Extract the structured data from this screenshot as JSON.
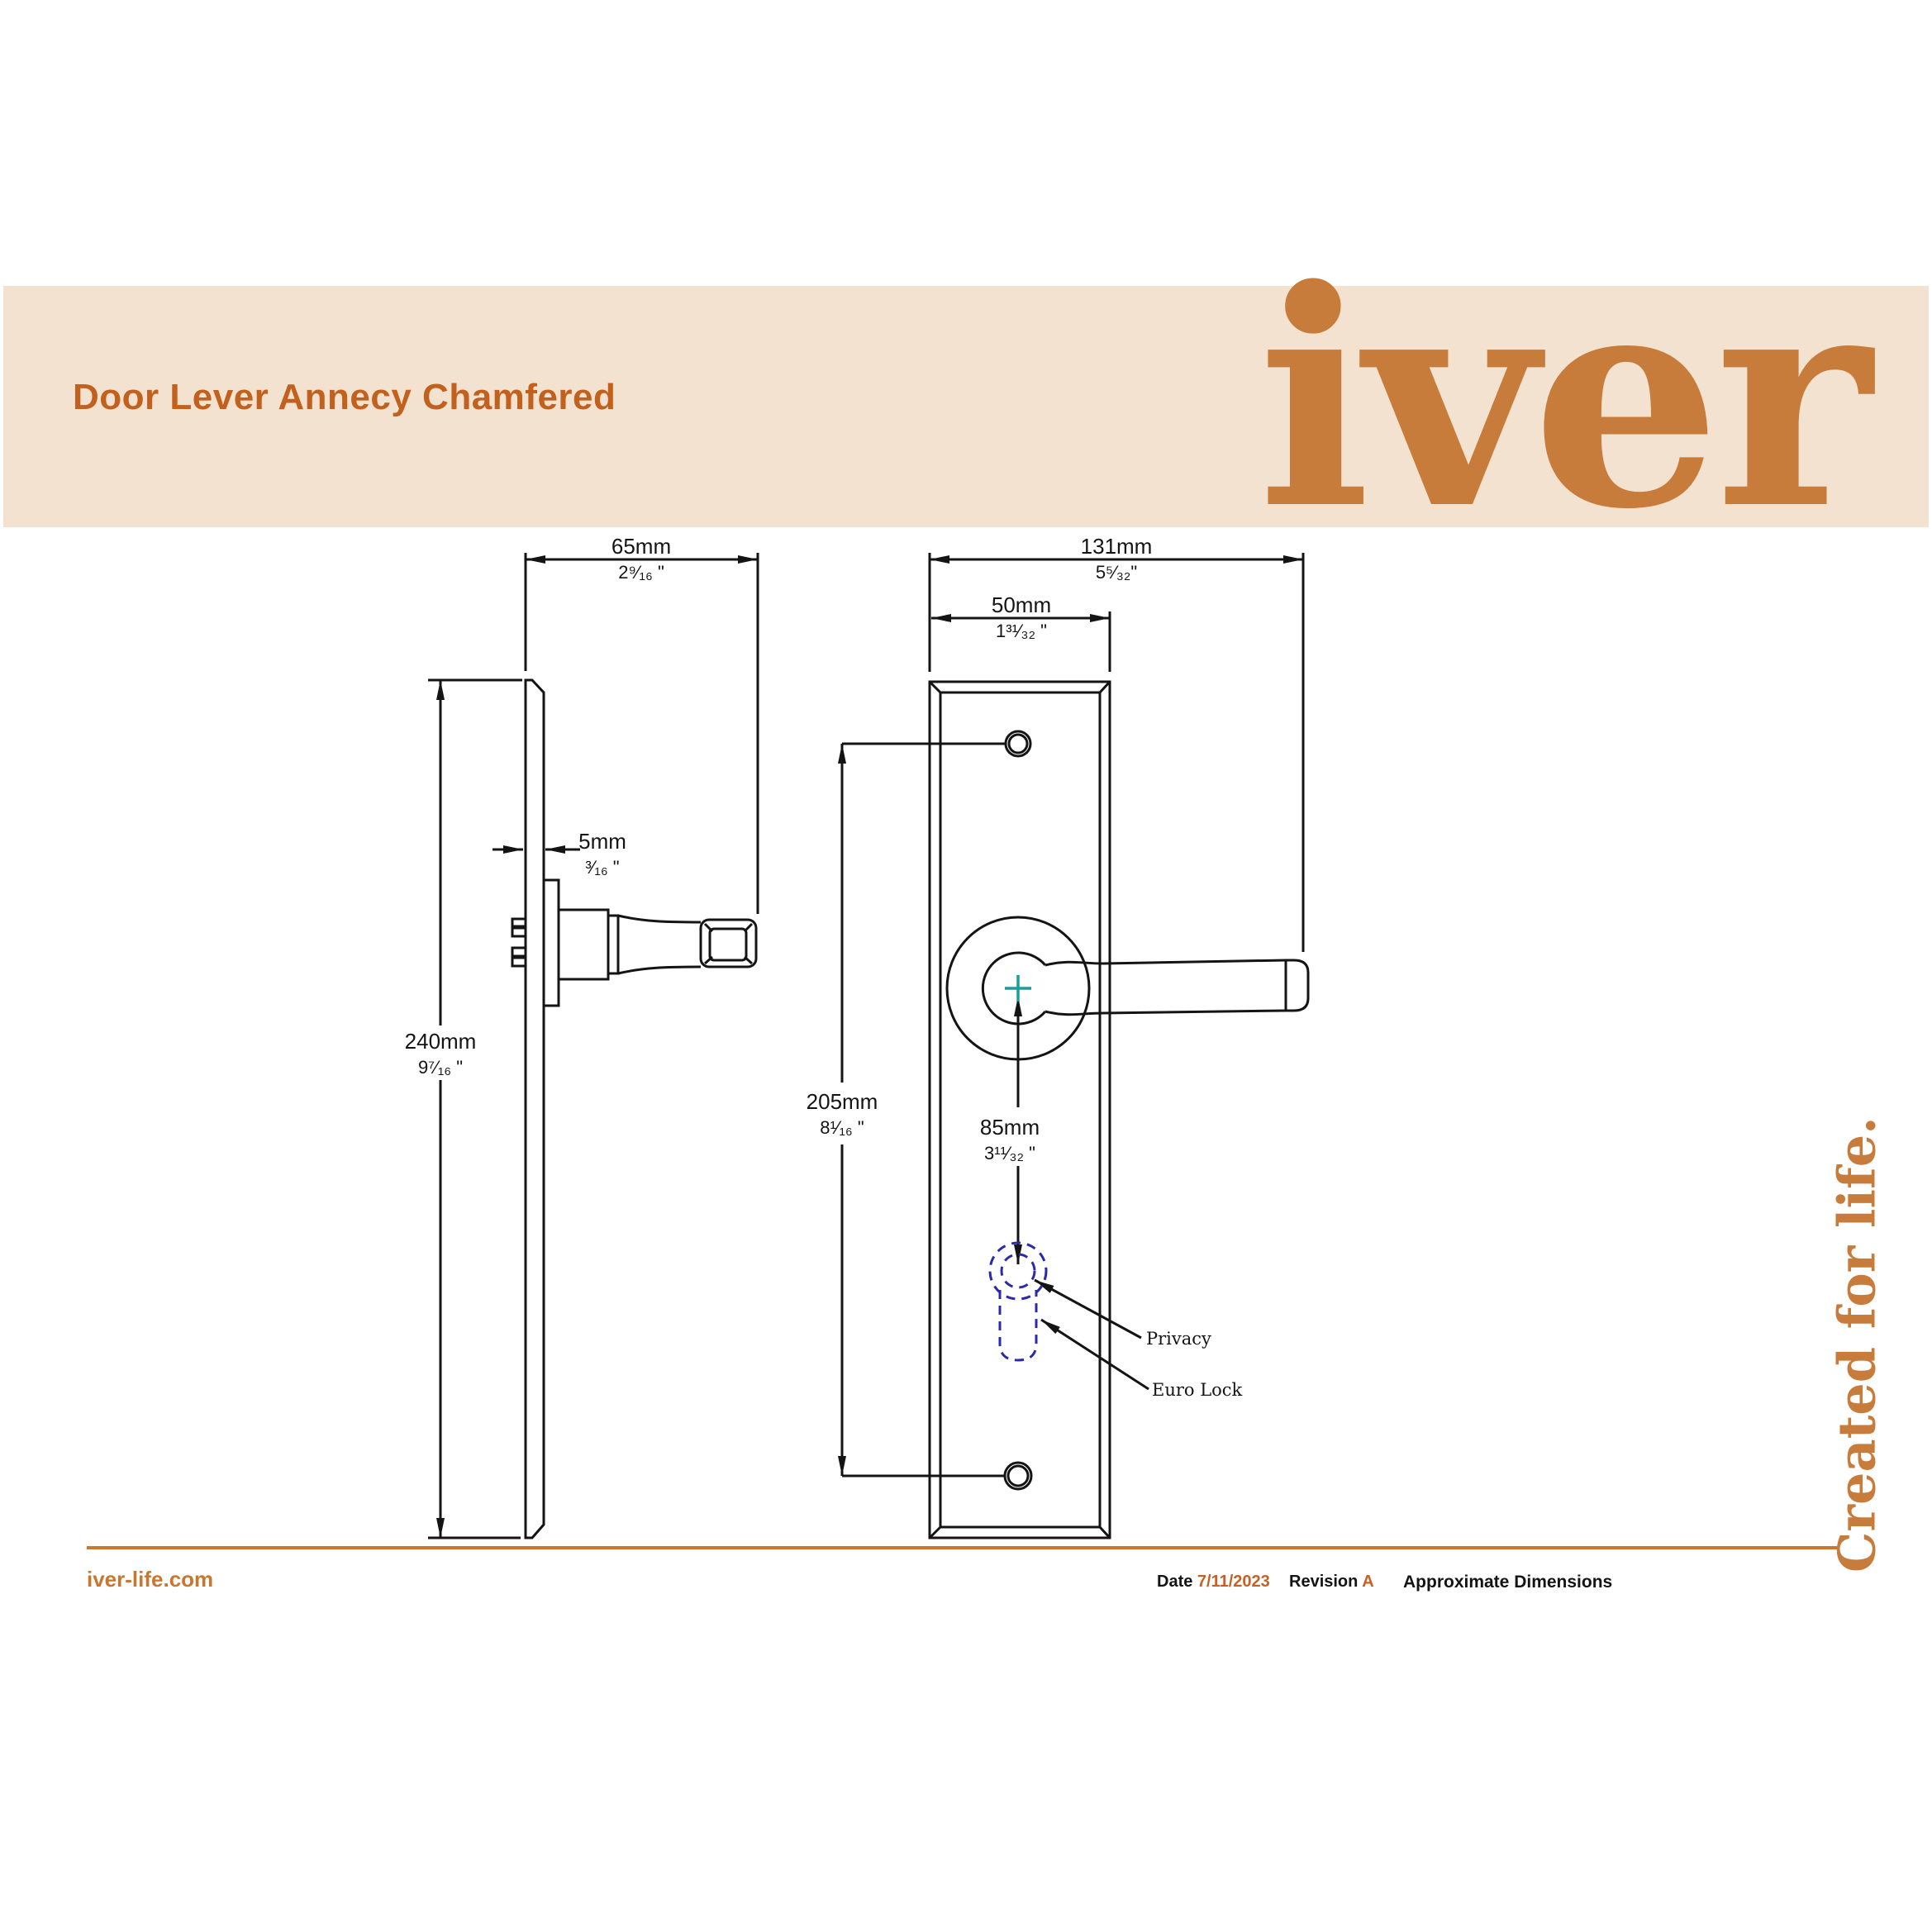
{
  "header": {
    "title": "Door Lever Annecy Chamfered",
    "logo_text": "iver"
  },
  "tagline": "Created for life.",
  "dims": {
    "plate_depth": {
      "mm": "65mm",
      "inch": "2⁹⁄₁₆ \""
    },
    "plate_thickness": {
      "mm": "5mm",
      "inch": "³⁄₁₆ \""
    },
    "plate_height": {
      "mm": "240mm",
      "inch": "9⁷⁄₁₆ \""
    },
    "overall_width": {
      "mm": "131mm",
      "inch": "5⁵⁄₃₂\""
    },
    "plate_width": {
      "mm": "50mm",
      "inch": "1³¹⁄₃₂ \""
    },
    "screw_centres": {
      "mm": "205mm",
      "inch": "8¹⁄₁₆ \""
    },
    "lock_centre": {
      "mm": "85mm",
      "inch": "3¹¹⁄₃₂ \""
    }
  },
  "callouts": {
    "privacy": "Privacy",
    "euro_lock": "Euro Lock"
  },
  "footer": {
    "website": "iver-life.com",
    "date_label": "Date",
    "date_value": "7/11/2023",
    "revision_label": "Revision",
    "revision_value": "A",
    "note": "Approximate Dimensions"
  },
  "colors": {
    "banner_beige": "#F3E2D0",
    "title_orange": "#C2601E",
    "logo_orange": "#C87C3B",
    "rule_orange": "#C9772E",
    "line_black": "#141414",
    "keyhole_navy": "#2B2BA8",
    "centre_teal": "#1E9C9C"
  }
}
